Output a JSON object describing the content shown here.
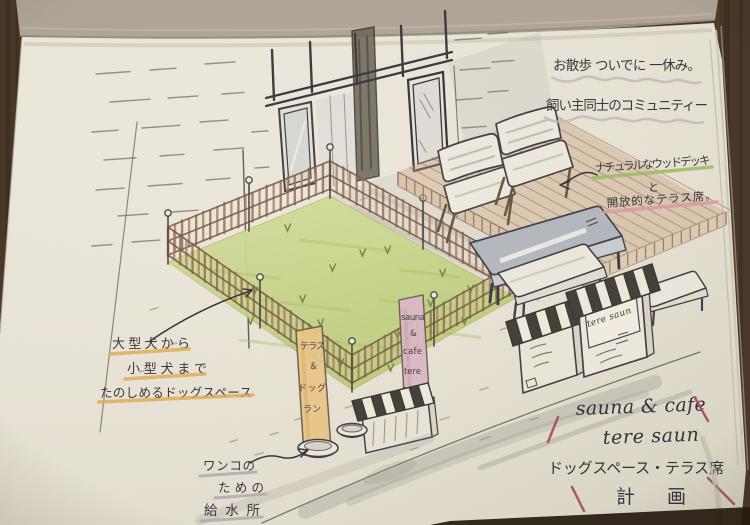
{
  "annotations": {
    "stroll": {
      "line1": "お散歩 ついでに 一休み。",
      "line2": "飼い主同士のコミュニティー"
    },
    "deck_note": {
      "line1": "ナチュラルなウッドデッキ",
      "connector": "と",
      "line2": "開放的なテラス席。"
    },
    "dog_note": {
      "line1": "大型犬から",
      "line2": "小型犬まで",
      "line3": "たのしめるドッグスペース"
    },
    "water_note": {
      "line1": "ワンコの",
      "line2": "ための",
      "line3": "給水所"
    }
  },
  "signs": {
    "terrace_banner": {
      "line1": "テラス",
      "line2": "＆",
      "line3": "ドッグ",
      "line4": "ラン"
    },
    "cafe_banner": {
      "line1": "sauna",
      "line2": "&",
      "line3": "cafe",
      "line4": "tere",
      "line5": "saun"
    },
    "stall_sign": "tere saun"
  },
  "title": {
    "line1": "sauna & cafe",
    "line2": "tere saun",
    "line3": "ドッグスペース・テラス席",
    "line4": "計画"
  },
  "colors": {
    "ink": "#3b393f",
    "pencil": "#5c5950",
    "pencil_brown": "#9b7a5d",
    "fence_rail": "#7e6148",
    "fence_slat_a": "#ab8468",
    "fence_slat_b": "#93705a",
    "grass_green": "#c9d489",
    "grass_streak": "#a9bf69",
    "tuft_green": "#6d8c43",
    "deck_brown": "#c9a07c",
    "plank_line": "#9b7355",
    "awning_dark": "#45423c",
    "awning_light": "#f0ebdd",
    "banner_orange": "#ecc88c",
    "banner_pink": "#dcbac7",
    "table_gray": "#b5b9c0",
    "road_gray": "#8f8c84",
    "underline_green": "#9cc069",
    "underline_pink": "#de9ba9",
    "underline_orange": "#e2ae52",
    "underline_gray": "#a9aeae",
    "wavy_gray": "#bcc1bd",
    "title_accent": "#a3505f",
    "paper": "#efeadd",
    "desk": "#4a3829"
  }
}
